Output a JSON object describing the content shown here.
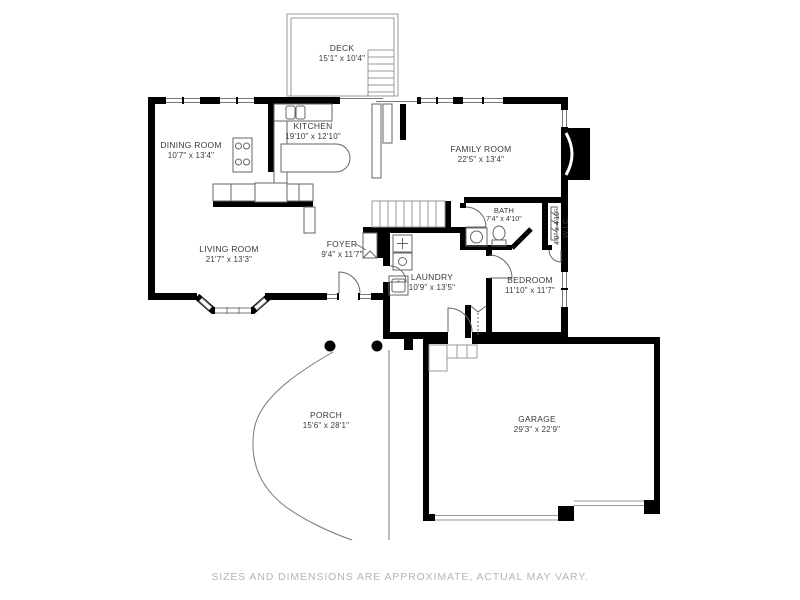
{
  "rooms": {
    "deck": {
      "name": "DECK",
      "dims": "15'1\" x 10'4\""
    },
    "kitchen": {
      "name": "KITCHEN",
      "dims": "19'10\" x 12'10\""
    },
    "dining_room": {
      "name": "DINING ROOM",
      "dims": "10'7\" x 13'4\""
    },
    "family_room": {
      "name": "FAMILY ROOM",
      "dims": "22'5\" x 13'4\""
    },
    "living_room": {
      "name": "LIVING ROOM",
      "dims": "21'7\" x 13'3\""
    },
    "foyer": {
      "name": "FOYER",
      "dims": "9'4\" x 11'7\""
    },
    "laundry": {
      "name": "LAUNDRY",
      "dims": "10'9\" x 13'5\""
    },
    "bath": {
      "name": "BATH",
      "dims": "7'4\" x 4'10\""
    },
    "wic": {
      "name": "W.I.C.",
      "dims": "4'0\" x 4'10\""
    },
    "bedroom": {
      "name": "BEDROOM",
      "dims": "11'10\" x 11'7\""
    },
    "porch": {
      "name": "PORCH",
      "dims": "15'6\" x 28'1\""
    },
    "garage": {
      "name": "GARAGE",
      "dims": "29'3\" x 22'9\""
    }
  },
  "footer": {
    "disclaimer": "SIZES AND DIMENSIONS ARE APPROXIMATE, ACTUAL MAY VARY."
  },
  "colors": {
    "wall": "#000000",
    "fixture_line": "#666666",
    "light_line": "#999999",
    "label_text": "#3a3a3a",
    "disclaimer_text": "#b5b5b5"
  }
}
